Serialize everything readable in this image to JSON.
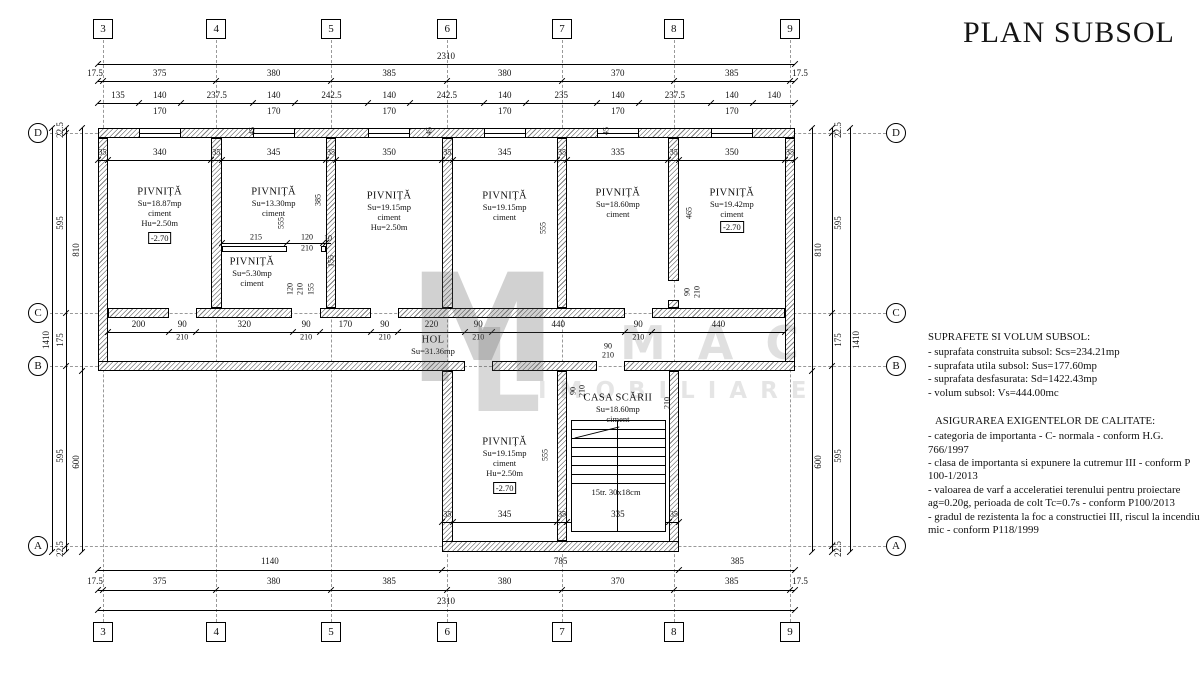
{
  "title": "PLAN SUBSOL",
  "watermark": {
    "monogram": "M",
    "monogram2": "L",
    "letters": "MAC",
    "word": "IMOBILIARE"
  },
  "grid": {
    "columns": [
      "3",
      "4",
      "5",
      "6",
      "7",
      "8",
      "9"
    ],
    "rows": [
      "D",
      "C",
      "B",
      "A"
    ]
  },
  "rooms": [
    {
      "name": "PIVNIȚĂ",
      "lines": [
        "Su=18.87mp",
        "ciment",
        "Hu=2.50m"
      ],
      "level": "-2.70"
    },
    {
      "name": "PIVNIȚĂ",
      "lines": [
        "Su=13.30mp",
        "ciment"
      ]
    },
    {
      "name": "PIVNIȚĂ",
      "lines": [
        "Su=5.30mp",
        "ciment"
      ]
    },
    {
      "name": "PIVNIȚĂ",
      "lines": [
        "Su=19.15mp",
        "ciment",
        "Hu=2.50m"
      ]
    },
    {
      "name": "PIVNIȚĂ",
      "lines": [
        "Su=19.15mp",
        "ciment"
      ]
    },
    {
      "name": "PIVNIȚĂ",
      "lines": [
        "Su=18.60mp",
        "ciment"
      ]
    },
    {
      "name": "PIVNIȚĂ",
      "lines": [
        "Su=19.42mp",
        "ciment"
      ],
      "level": "-2.70"
    },
    {
      "name": "HOL",
      "lines": [
        "Su=31.36mp"
      ]
    },
    {
      "name": "PIVNIȚĂ",
      "lines": [
        "Su=19.15mp",
        "ciment",
        "Hu=2.50m"
      ],
      "level": "-2.70"
    },
    {
      "name": "CASA SCĂRII",
      "lines": [
        "Su=18.60mp",
        "ciment"
      ]
    }
  ],
  "stair_note": "15tr. 30x18cm",
  "dims": {
    "top_total": "2310",
    "axis_chain": [
      "17.5",
      "375",
      "380",
      "385",
      "380",
      "370",
      "385",
      "17.5"
    ],
    "top_detail": [
      "135",
      "140",
      "237.5",
      "140",
      "242.5",
      "140",
      "242.5",
      "140",
      "235",
      "140",
      "237.5",
      "140",
      "140"
    ],
    "window_sub": "170",
    "room_widths": [
      "340",
      "345",
      "350",
      "345",
      "335",
      "350"
    ],
    "wall_thickness": "35",
    "window_mark": "45",
    "corridor_chain": [
      "200",
      "90",
      "320",
      "90",
      "170",
      "90",
      "220",
      "90",
      "440",
      "90",
      "440"
    ],
    "door_width": "90",
    "door_height": "210",
    "room_heights": {
      "r1": "555",
      "r2_upper": "385",
      "r4": "555",
      "r6": "465",
      "lower": "555"
    },
    "subroom_chain": [
      "215",
      "120",
      "10"
    ],
    "subroom_vert": [
      "155",
      "120",
      "210",
      "155"
    ],
    "lower_widths": [
      "345",
      "335"
    ],
    "bottom_blocks": [
      "1140",
      "785",
      "385"
    ],
    "bottom_total": "2310",
    "left_chain": [
      "22.5",
      "595",
      "175",
      "595",
      "22.5"
    ],
    "left_blocks": [
      "810",
      "600"
    ],
    "left_total": "1410"
  },
  "notes": {
    "surfaces_title": "SUPRAFETE SI VOLUM SUBSOL:",
    "surfaces": [
      "- suprafata construita subsol: Scs=234.21mp",
      "- suprafata utila subsol: Sus=177.60mp",
      "- suprafata desfasurata: Sd=1422.43mp",
      "- volum subsol: Vs=444.00mc"
    ],
    "quality_title": "ASIGURAREA EXIGENTELOR DE CALITATE:",
    "quality": [
      "- categoria de importanta - C- normala - conform H.G. 766/1997",
      "- clasa de importanta si expunere la cutremur III - conform P 100-1/2013",
      "- valoarea de varf a acceleratiei terenului pentru proiectare ag=0.20g,   perioada de colt Tc=0.7s - conform P100/2013",
      "- gradul de rezistenta la foc a constructiei III, riscul la incendiu mic - conform P118/1999"
    ]
  }
}
